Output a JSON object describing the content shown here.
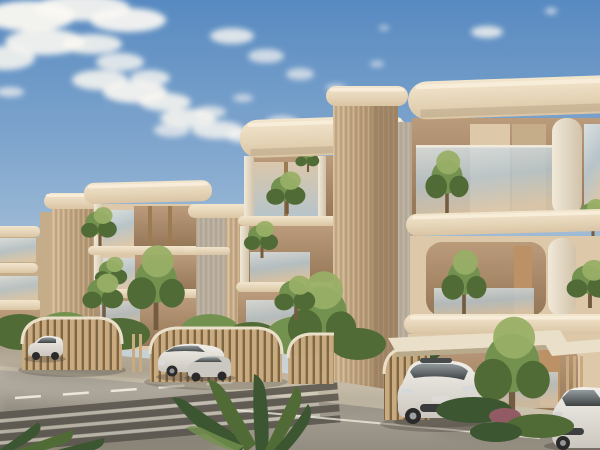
{
  "scene": {
    "type": "architectural-exterior-rendering",
    "description": "Sunlit low-rise residential complex of cream and sand colored apartment buildings with rounded overhanging roof slabs, fluted stone towers, glass balcony railings and balcony trees; arched timber-slat carports shelter parked cars beside an asphalt street with a zebra crosswalk and dashed lane line under a blue sky with scattered clouds.",
    "objects": [
      "blue sky with scattered white clouds",
      "far left apartment block with stacked balconies",
      "left apartment block with fluted tower and glass balconies",
      "receding middle apartment block",
      "center apartment block with tall fluted tower",
      "large right apartment block with rounded roof slab and round columns",
      "balcony trees and shrubs",
      "arched timber-slat carports",
      "white SUV parked at left curb",
      "white SUV and silver car parked at center carport",
      "white SUV parked under right carport",
      "white coupe at lower right edge",
      "concrete parking apron",
      "asphalt road with dashed center line and edge line",
      "zebra crosswalk at lower left",
      "dark tropical foreground plants"
    ],
    "time_of_day": "late afternoon golden light",
    "sky_coverage": "partly cloudy, cloud band across upper left"
  },
  "palette": {
    "sky_top": "#4f86c2",
    "sky_mid": "#84abd3",
    "sky_low": "#bcd0dd",
    "sky_horizon": "#ded9d0",
    "cloud": "#fbfaf6",
    "slab_light": "#f2e7d0",
    "slab_dark": "#d9c5a4",
    "slab_highlight": "#f7efdc",
    "slab_underside": "#b3a184",
    "tower_light": "#d2b994",
    "tower_dark": "#ad916c",
    "tower_side": "#9b8161",
    "flute_line": "#8a7050",
    "panel_light": "#dcc9a9",
    "panel_dark": "#c3ab87",
    "glass_light": "#d9e1e3",
    "glass_mid": "#b3c3cb",
    "glass_warm": "#d8c7ac",
    "interior_light": "#b79878",
    "interior_dark": "#8f7253",
    "wood_frame": "#97774f",
    "wood_panel": "#b98e62",
    "white_column_light": "#f1eadb",
    "white_column_dark": "#cfc2aa",
    "gray_wall": "#b6ad9f",
    "leaf_bright": "#93ad62",
    "leaf_mid": "#6d8f4a",
    "leaf_dark": "#47662f",
    "leaf_deep": "#31502a",
    "trunk": "#6d563c",
    "bush_magenta": "#8d5560",
    "slat_base": "#c8a97e",
    "slat_gap": "#77603f",
    "canopy_top": "#e9e0cb",
    "canopy_edge": "#b7a88b",
    "ground_light": "#c9c1ae",
    "ground_shadow": "#a89f8d",
    "road_light": "#b2ada3",
    "road_dark": "#8e897e",
    "crosswalk_dark": "#4e4b45",
    "marking_white": "#eeebe2",
    "shadow": "#3e3a33",
    "car_white": "#f2f1ed",
    "car_white_shade": "#c9c7c1",
    "car_silver": "#c9c8c3",
    "car_glass": "#343a3d",
    "car_glass_light": "#8e999e",
    "tire": "#1f2123"
  }
}
